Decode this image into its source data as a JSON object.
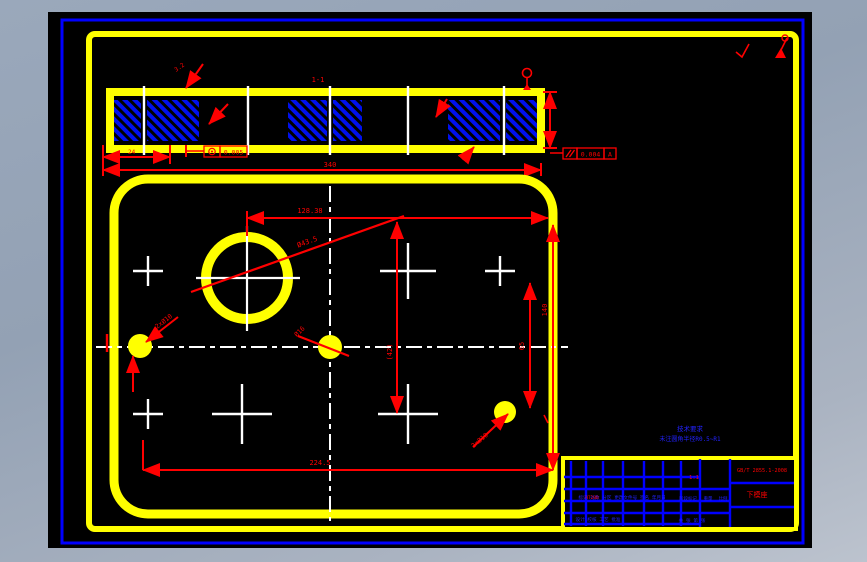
{
  "app": {
    "kind": "cad-drawing-viewport"
  },
  "section": {
    "label": "1-1",
    "roughness": "3.2",
    "dim_left": "24",
    "dim_total": "340",
    "tol_concentric": "0.005",
    "tol_parallel": "0.004",
    "tol_datum": "A"
  },
  "plan": {
    "dim_top": "128.38",
    "dim_diag": "Ø43.5",
    "hole_left": "2xØ10",
    "hole_center": "Ø16",
    "hole_right": "2xØ10",
    "dim_v_mid": "(42)",
    "dim_v_right": "65",
    "dim_v_edge": "140",
    "dim_bottom": "224.5"
  },
  "notes": {
    "line1": "技术要求",
    "line2": "未注圆角半径R0.5~R1"
  },
  "title_block": {
    "rev_row": "标记 处数 分区 更改文件号 签名 年月日",
    "sign_row": "设计 校核 工艺 批准",
    "stage_label": "阶段标记",
    "weight_label": "重量",
    "scale_label": "比例",
    "scale_value": "1:1",
    "material": "HT200",
    "sheet_info": "共 张 第 张",
    "standard_no": "GB/T 2855.1-2008",
    "part_name": "下模座"
  },
  "colors": {
    "line_yellow": "#ffff00",
    "line_blue": "#0000ff",
    "annotation_red": "#ff0000",
    "centerline_white": "#ffffff",
    "paper_black": "#000000"
  }
}
